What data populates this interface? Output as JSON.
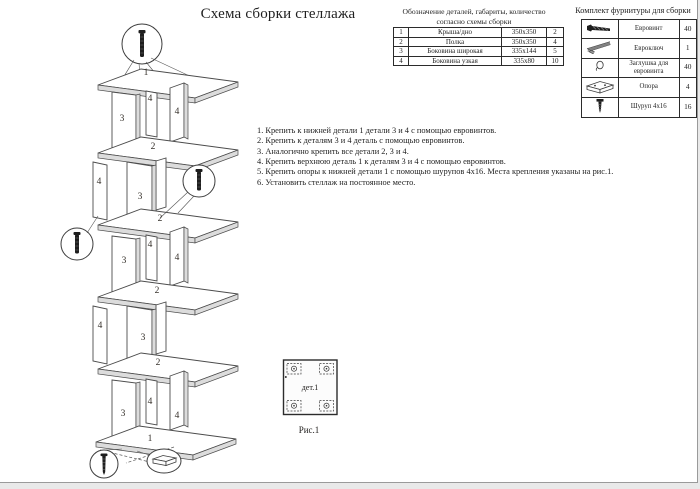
{
  "page": {
    "title": "Схема сборки стеллажа"
  },
  "parts_table": {
    "header_line1": "Обозначение деталей, габариты, количество",
    "header_line2": "согласно схемы сборки",
    "rows": [
      {
        "num": "1",
        "name": "Крыша/дно",
        "size": "350х350",
        "qty": "2"
      },
      {
        "num": "2",
        "name": "Полка",
        "size": "350х350",
        "qty": "4"
      },
      {
        "num": "3",
        "name": "Боковина широкая",
        "size": "335х144",
        "qty": "5"
      },
      {
        "num": "4",
        "name": "Боковина узкая",
        "size": "335х80",
        "qty": "10"
      }
    ]
  },
  "hardware_table": {
    "title": "Комплект фурнитуры для сборки",
    "rows": [
      {
        "icon": "euro-screw-icon",
        "name": "Евровинт",
        "qty": "40"
      },
      {
        "icon": "hex-key-icon",
        "name": "Евроключ",
        "qty": "1"
      },
      {
        "icon": "cap-icon",
        "name": "Заглушка для евровинта",
        "qty": "40"
      },
      {
        "icon": "support-icon",
        "name": "Опора",
        "qty": "4"
      },
      {
        "icon": "screw-icon",
        "name": "Шуруп 4х16",
        "qty": "16"
      }
    ]
  },
  "instructions": [
    "1. Крепить к нижней детали 1 детали 3 и 4 с помощью евровинтов.",
    "2. Крепить к деталям 3 и 4 деталь с помощью евровинтов.",
    "3. Аналогично крепить все детали 2, 3 и 4.",
    "4. Крепить верхнюю деталь 1 к деталям 3 и 4 с помощью евровинтов.",
    "5. Крепить опоры к нижней детали 1 с помощью шурупов 4х16. Места крепления указаны на рис.1.",
    "6. Установить стеллаж на постоянное место."
  ],
  "diagram": {
    "labels": [
      {
        "t": "1"
      },
      {
        "t": "4"
      },
      {
        "t": "4"
      },
      {
        "t": "3"
      },
      {
        "t": "2"
      },
      {
        "t": "4"
      },
      {
        "t": "3"
      },
      {
        "t": "2"
      },
      {
        "t": "4"
      },
      {
        "t": "3"
      },
      {
        "t": "4"
      },
      {
        "t": "2"
      },
      {
        "t": "4"
      },
      {
        "t": "3"
      },
      {
        "t": "2"
      },
      {
        "t": "4"
      },
      {
        "t": "3"
      },
      {
        "t": "4"
      },
      {
        "t": "1"
      }
    ]
  },
  "figure1": {
    "label": "дет.1",
    "caption": "Рис.1"
  },
  "colors": {
    "text": "#1f1f1f",
    "diagram_line": "#4c4c4c",
    "page_bg": "#ffffff"
  }
}
